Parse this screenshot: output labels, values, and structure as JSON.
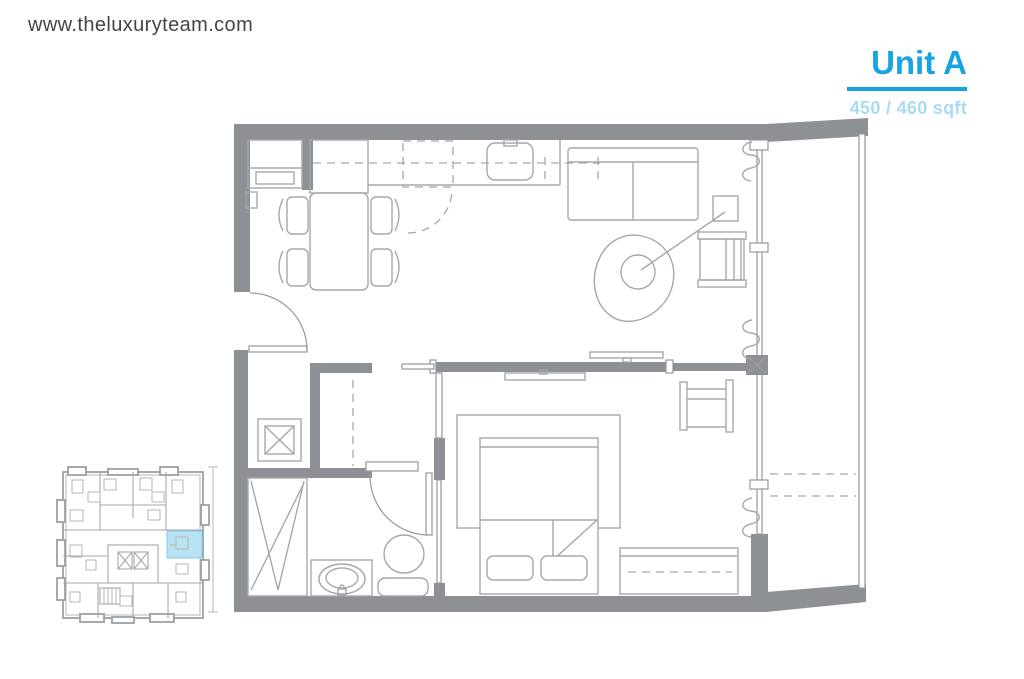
{
  "header": {
    "website_url": "www.theluxuryteam.com"
  },
  "unit_card": {
    "title": "Unit A",
    "area_label": "450 / 460 sqft",
    "accent_color": "#18a3e2",
    "area_text_color": "#a9dcf0"
  },
  "floor_plan": {
    "colors": {
      "wall_fill": "#8d9094",
      "line": "#a5a8ab",
      "dashed_line": "#a5a8ab"
    },
    "elements": [
      "entry-door",
      "entry-closet",
      "shoe-cabinet",
      "dining-table",
      "dining-chairs",
      "kitchen-counter",
      "kitchen-sink",
      "fridge-dashed",
      "upper-cabinets-dashed",
      "cabinet-swing-dashed",
      "sofa",
      "floor-lamp",
      "armchair",
      "living-tv",
      "bedroom-tv",
      "curtains",
      "window-wall",
      "balcony",
      "balcony-divider-dashed",
      "sliding-door",
      "wardrobe-closet",
      "utility-box",
      "shower",
      "vanity-sink",
      "toilet",
      "bathroom-door",
      "pocket-door",
      "area-rug",
      "bed",
      "pillows",
      "blanket-fold",
      "desk-chair",
      "dresser"
    ]
  },
  "key_plan": {
    "highlight_color": "#b7e3f2",
    "highlight_stroke": "#85cce6",
    "elements": [
      "building-outline",
      "unit-partitions",
      "elevators",
      "stairs",
      "highlighted-unit",
      "dimension-line"
    ]
  }
}
